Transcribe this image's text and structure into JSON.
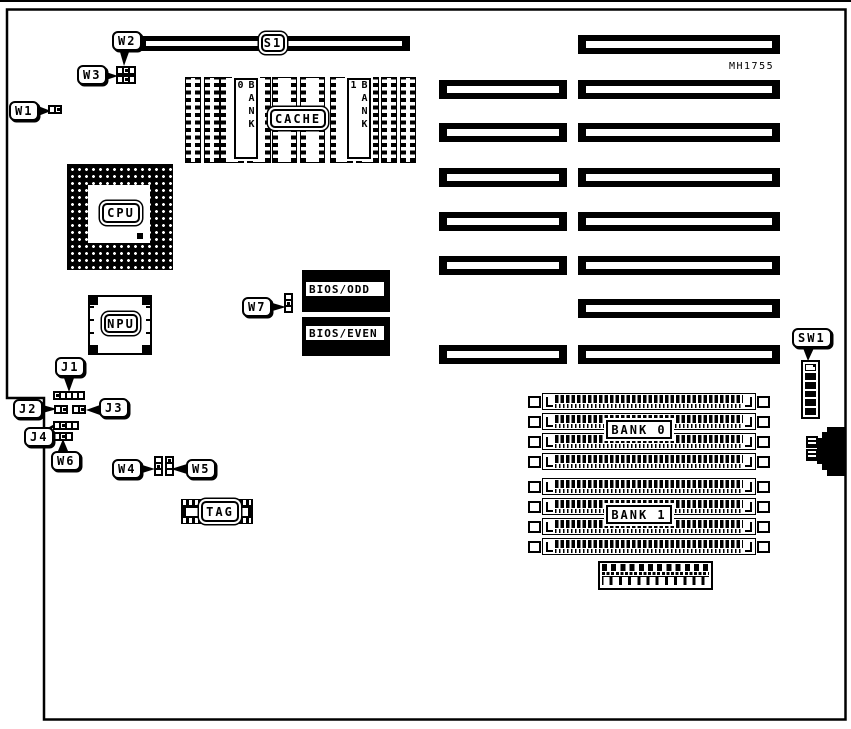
{
  "board": {
    "part_number": "MH1755"
  },
  "callouts": {
    "w1": "W1",
    "w2": "W2",
    "w3": "W3",
    "w4": "W4",
    "w5": "W5",
    "w6": "W6",
    "w7": "W7",
    "j1": "J1",
    "j2": "J2",
    "j3": "J3",
    "j4": "J4",
    "s1": "S1",
    "sw1": "SW1"
  },
  "chips": {
    "cpu": "CPU",
    "npu": "NPU",
    "cache": "CACHE",
    "cache_bank0": "BANK 0",
    "cache_bank1": "BANK 1",
    "bios_odd": "BIOS/ODD",
    "bios_even": "BIOS/EVEN",
    "tag": "TAG",
    "memory_bank0": "BANK 0",
    "memory_bank1": "BANK 1"
  },
  "colors": {
    "ink": "#000000",
    "background": "#ffffff"
  }
}
